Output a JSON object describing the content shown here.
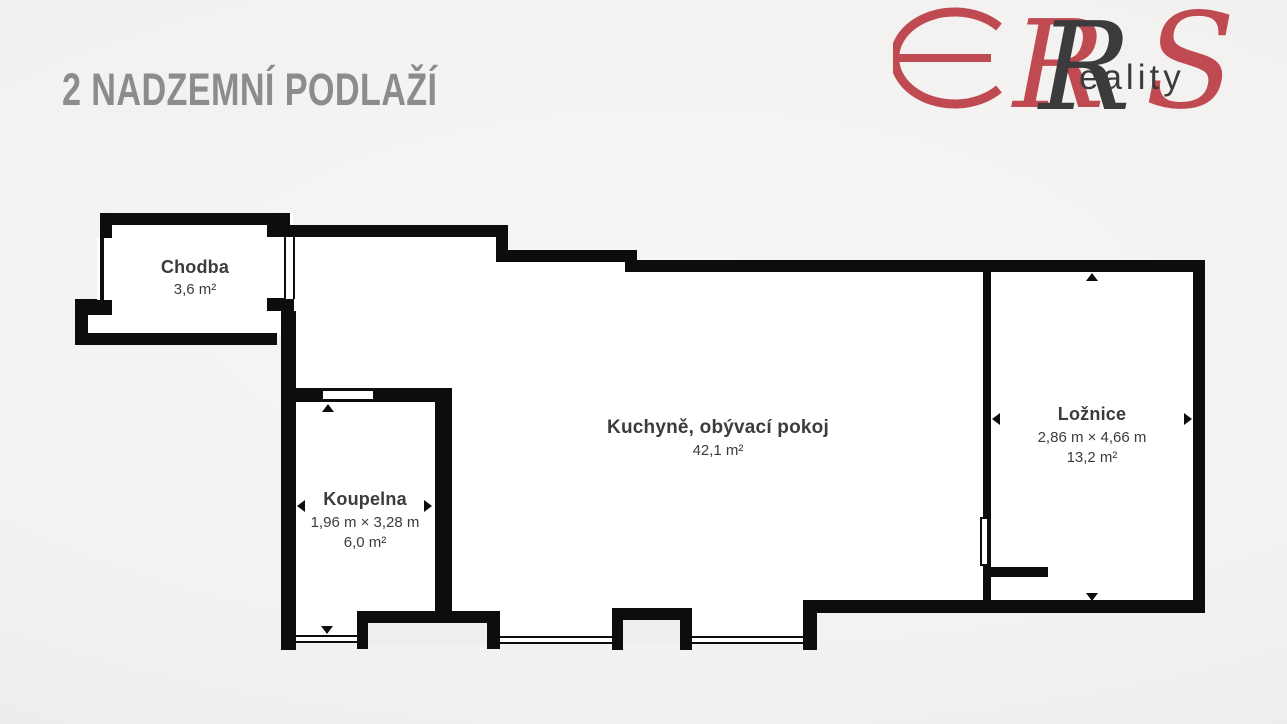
{
  "header": {
    "title": "2 NADZEMNÍ PODLAŽÍ",
    "title_color": "#8c8c8c"
  },
  "logo": {
    "brand": "ERS Reality",
    "monogram_r": "R",
    "monogram_s": "S",
    "wordmark_rest": "eality",
    "red": "#c04a52",
    "dark": "#3b3b3e"
  },
  "floorplan": {
    "wall_color": "#0d0d0d",
    "room_fill": "#ffffff",
    "rooms": [
      {
        "id": "chodba",
        "name": "Chodba",
        "area": "3,6 m²"
      },
      {
        "id": "koupelna",
        "name": "Koupelna",
        "dimensions": "1,96 m × 3,28 m",
        "area": "6,0 m²"
      },
      {
        "id": "kuchyne-obyvaci-pokoj",
        "name": "Kuchyně, obývací pokoj",
        "area": "42,1 m²"
      },
      {
        "id": "loznice",
        "name": "Ložnice",
        "dimensions": "2,86 m × 4,66 m",
        "area": "13,2 m²"
      }
    ]
  }
}
